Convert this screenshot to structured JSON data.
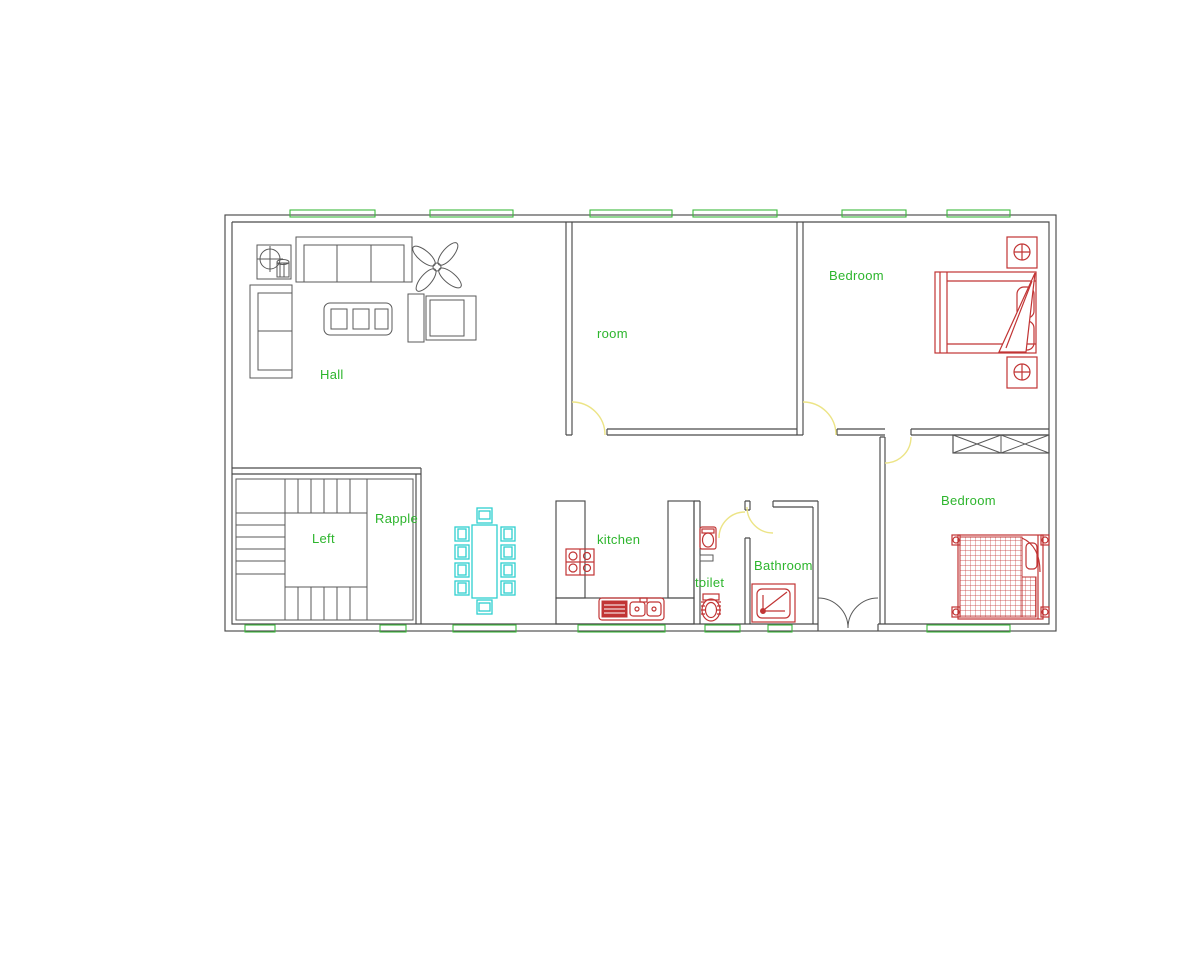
{
  "labels": {
    "hall": "Hall",
    "room": "room",
    "bedroom_top": "Bedroom",
    "bedroom_bottom": "Bedroom",
    "stairs_landing": "Left",
    "stairs_side": "Rapple",
    "kitchen": "kitchen",
    "toilet": "toilet",
    "bathroom": "Bathroom"
  },
  "colors": {
    "wall_line": "#4a4a4a",
    "furniture_red": "#c13434",
    "dining_cyan": "#2ecfcf",
    "label_green": "#2db52d",
    "window_green": "#3cba3c",
    "door_yellow": "#ece486",
    "background": "#ffffff"
  },
  "entities": [
    "exterior-walls",
    "interior-walls",
    "staircase",
    "ceiling-fan",
    "corner-unit",
    "sofa-three-seat",
    "sofa-two-seat",
    "coffee-table",
    "armchair",
    "side-table",
    "dining-table-set",
    "kitchen-counter",
    "stove",
    "double-sink",
    "wash-basin",
    "wc-toilet",
    "shower-tray",
    "double-bed",
    "single-bed",
    "nightstand-lamps",
    "wardrobe",
    "window-markers",
    "door-swings",
    "entrance-double-door"
  ]
}
